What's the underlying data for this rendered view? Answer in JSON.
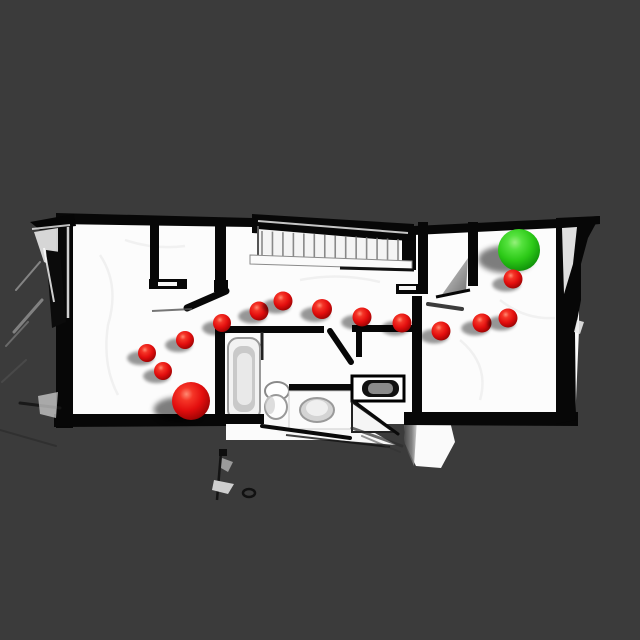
{
  "view": {
    "background_color": "#3b3b3b",
    "floor_color": "#fcfcfc",
    "wall_color": "#070707"
  },
  "markers": {
    "goal": {
      "name": "goal-sphere",
      "color": "#2ed31c",
      "x": 519,
      "y": 250,
      "r": 21
    },
    "start": {
      "name": "start-sphere",
      "color": "#e81212",
      "x": 191,
      "y": 401,
      "r": 19
    },
    "waypoint_color": "#e81212",
    "waypoints": [
      {
        "x": 147,
        "y": 353,
        "r": 9
      },
      {
        "x": 163,
        "y": 371,
        "r": 9
      },
      {
        "x": 185,
        "y": 340,
        "r": 9
      },
      {
        "x": 222,
        "y": 323,
        "r": 9
      },
      {
        "x": 259,
        "y": 311,
        "r": 9.5
      },
      {
        "x": 283,
        "y": 301,
        "r": 9.5
      },
      {
        "x": 322,
        "y": 309,
        "r": 10
      },
      {
        "x": 362,
        "y": 317,
        "r": 9.5
      },
      {
        "x": 402,
        "y": 323,
        "r": 9.5
      },
      {
        "x": 441,
        "y": 331,
        "r": 9.5
      },
      {
        "x": 482,
        "y": 323,
        "r": 9.5
      },
      {
        "x": 508,
        "y": 318,
        "r": 9.5
      },
      {
        "x": 513,
        "y": 279,
        "r": 9.5
      }
    ],
    "stair_tread_count": 13
  }
}
